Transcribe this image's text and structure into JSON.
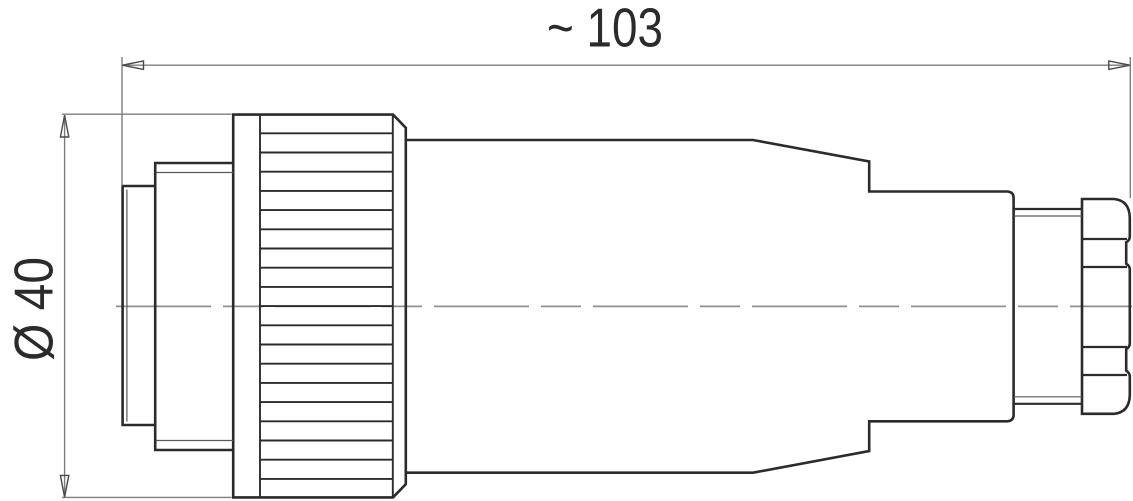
{
  "dimensions": {
    "length": {
      "label": "~ 103"
    },
    "diameter": {
      "label": "Ø 40"
    }
  },
  "colors": {
    "outline": "#2b2b2b",
    "inner_line": "#5a5a5a",
    "dimension": "#7d7d7d",
    "arrow": "#4a4a4a",
    "centerline": "#8f8f8f",
    "text": "#2b2b2b",
    "background": "#ffffff"
  }
}
